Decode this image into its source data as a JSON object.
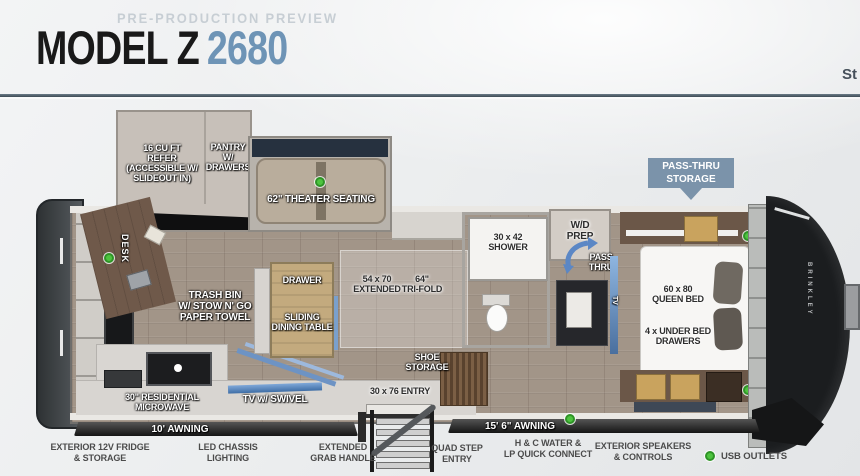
{
  "header": {
    "preview_label": "PRE-PRODUCTION PREVIEW",
    "model_name": "MODEL Z",
    "model_number": "2680",
    "right_partial_text": "St"
  },
  "colors": {
    "model_number_blue": "#6e94b6",
    "callout_blue": "#7b93aa",
    "usb_green": "#4ec43f",
    "divider": "#45525c"
  },
  "floorplan": {
    "slideouts": {
      "refer": "16 CU FT\nREFER\n(ACCESSIBLE W/\nSLIDEOUT IN)",
      "pantry": "PANTRY\nW/\nDRAWERS",
      "theater": "62\" THEATER SEATING"
    },
    "labels": {
      "desk": "DESK",
      "trash_bin": "TRASH BIN\nW/ STOW N' GO\nPAPER TOWEL",
      "drawer": "DRAWER",
      "dining_table": "SLIDING\nDINING TABLE",
      "sofa_extended": "54 x 70\nEXTENDED",
      "sofa_trifold": "64\"\nTRI-FOLD",
      "shower": "30 x 42\nSHOWER",
      "wd_prep": "W/D\nPREP",
      "pass_thru": "PASS\nTHRU",
      "queen_bed": "60 x 80\nQUEEN BED",
      "underbed_drawers": "4 x UNDER BED\nDRAWERS",
      "microwave": "30\" RESIDENTIAL\nMICROWAVE",
      "tv_swivel": "TV w/ SWIVEL",
      "shoe_storage": "SHOE\nSTORAGE",
      "entry": "30 x 76 ENTRY",
      "tv_vertical": "TV",
      "brand_vertical": "BRINKLEY"
    },
    "callouts": {
      "pass_thru_storage": "PASS-THRU\nSTORAGE",
      "awning_small": "10' AWNING",
      "awning_large": "15' 6\" AWNING"
    },
    "features": [
      {
        "label": "EXTERIOR 12V FRIDGE\n& STORAGE"
      },
      {
        "label": "LED CHASSIS\nLIGHTING"
      },
      {
        "label": "EXTENDED\nGRAB HANDLE"
      },
      {
        "label": "QUAD STEP\nENTRY"
      },
      {
        "label": "H & C WATER &\nLP QUICK CONNECT"
      },
      {
        "label": "EXTERIOR SPEAKERS\n& CONTROLS"
      }
    ],
    "legend": {
      "usb": "USB OUTLETS"
    }
  }
}
